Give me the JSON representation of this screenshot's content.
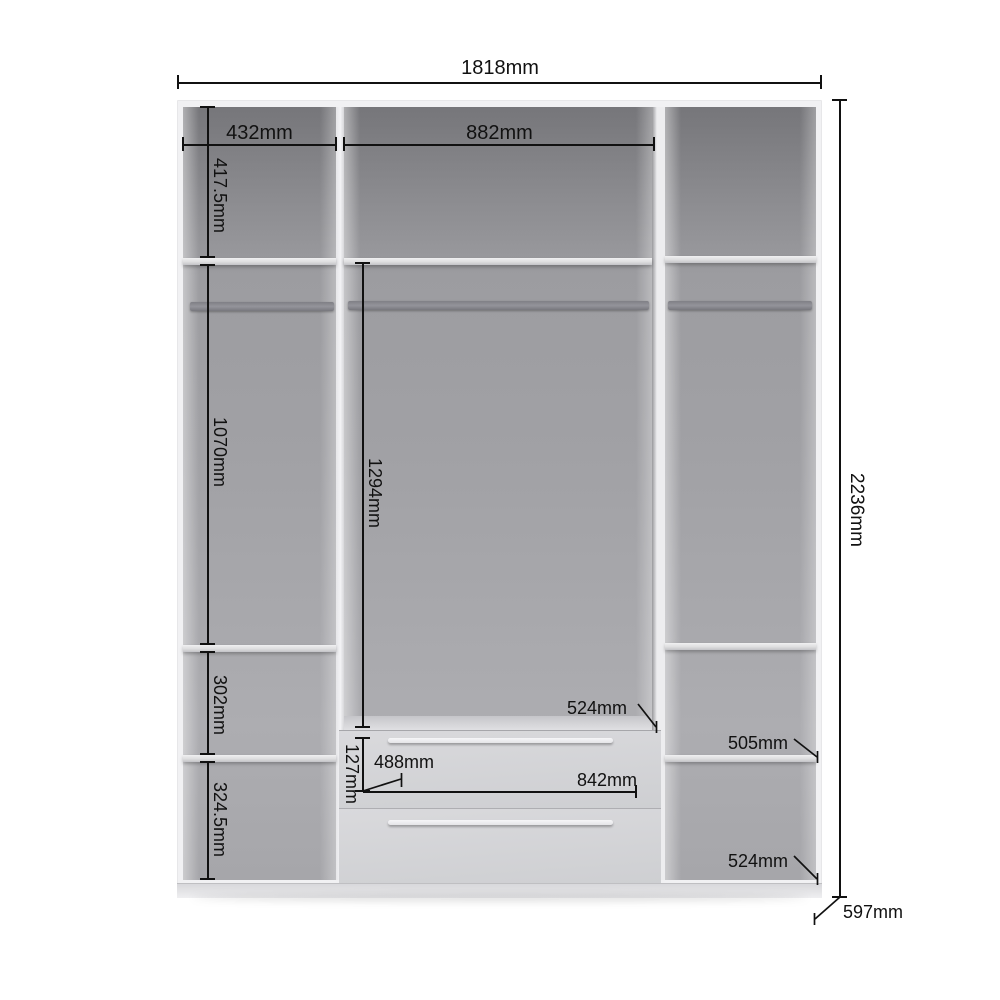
{
  "diagram": {
    "kind": "Wardrobe interior dimension drawing",
    "unit": "mm",
    "overall": {
      "width": "1818mm",
      "height": "2236mm",
      "depth": "597mm"
    },
    "sections": {
      "left": {
        "width": "432mm",
        "top_compartment_height": "417.5mm",
        "hanging_space_height": "1070mm",
        "shelf_compartment_height": "302mm",
        "bottom_compartment_height": "324.5mm"
      },
      "middle": {
        "width": "882mm",
        "hanging_space_height": "1294mm",
        "drawer_front_height": "127mm",
        "drawer_inner_width": "488mm",
        "drawer_width": "842mm",
        "drawer_depth": "524mm"
      },
      "right": {
        "shelf_depth": "505mm",
        "bottom_shelf_depth": "524mm"
      }
    },
    "colors": {
      "background": "#ffffff",
      "carcass": "#f1f1f3",
      "interior": "#9d9da1",
      "shelf": "#e3e3e6",
      "rail": "#85858b",
      "dimension_lines": "#111111"
    }
  }
}
